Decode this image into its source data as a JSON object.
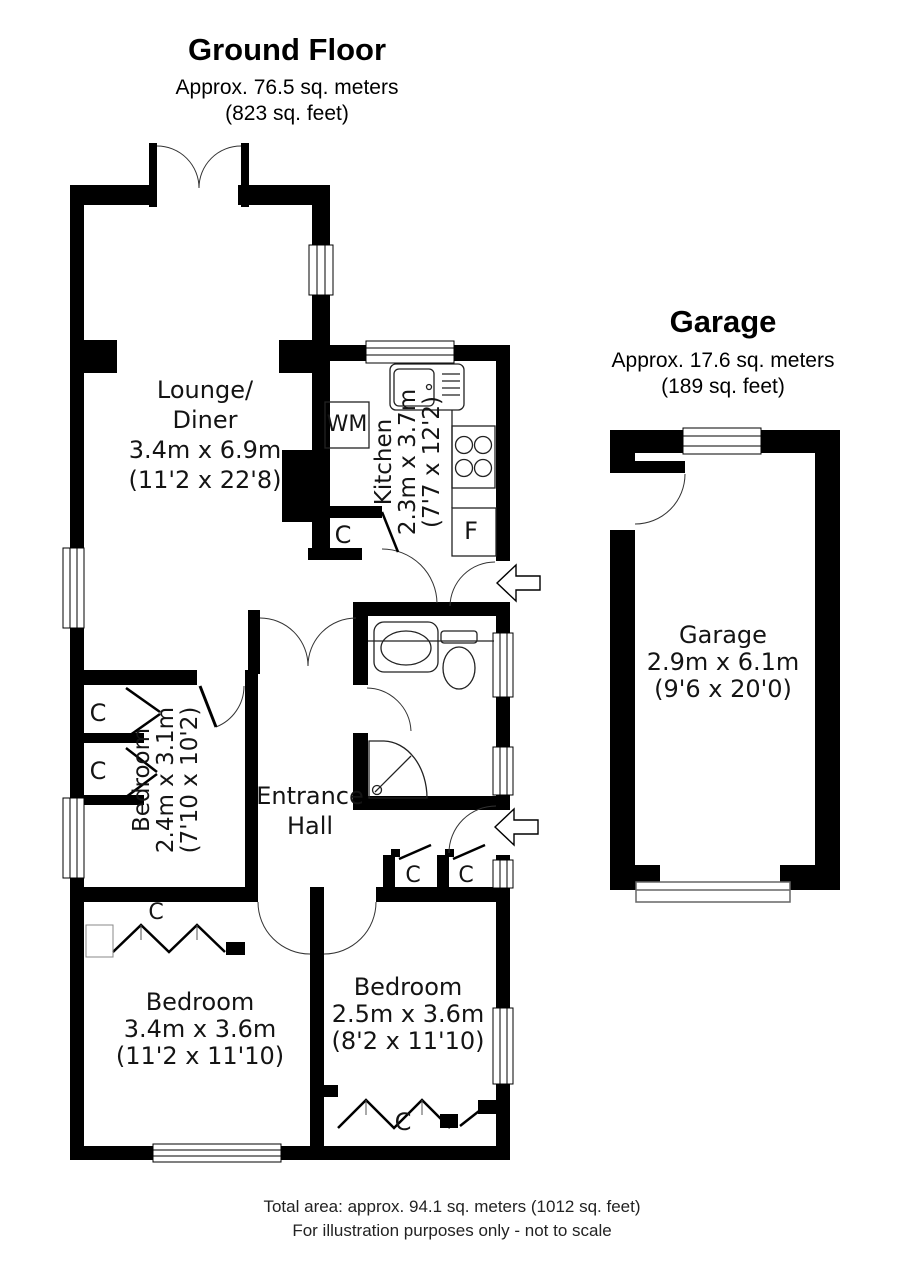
{
  "header": {
    "title": "Ground Floor",
    "area_metric": "Approx. 76.5 sq. meters",
    "area_imperial": "(823 sq. feet)"
  },
  "garage_header": {
    "title": "Garage",
    "area_metric": "Approx. 17.6 sq. meters",
    "area_imperial": "(189 sq. feet)"
  },
  "rooms": {
    "lounge": {
      "name_line1": "Lounge/",
      "name_line2": "Diner",
      "dims_metric": "3.4m x 6.9m",
      "dims_imperial": "(11'2 x 22'8)"
    },
    "kitchen": {
      "name": "Kitchen",
      "dims_metric": "2.3m x 3.7m",
      "dims_imperial": "(7'7 x 12'2)"
    },
    "bedroom_mid": {
      "name": "Bedroom",
      "dims_metric": "2.4m x 3.1m",
      "dims_imperial": "(7'10 x 10'2)"
    },
    "hall": {
      "name_line1": "Entrance",
      "name_line2": "Hall"
    },
    "bedroom_bottom_left": {
      "name": "Bedroom",
      "dims_metric": "3.4m x 3.6m",
      "dims_imperial": "(11'2 x 11'10)"
    },
    "bedroom_bottom_right": {
      "name": "Bedroom",
      "dims_metric": "2.5m x 3.6m",
      "dims_imperial": "(8'2 x 11'10)"
    },
    "garage": {
      "name": "Garage",
      "dims_metric": "2.9m x 6.1m",
      "dims_imperial": "(9'6 x 20'0)"
    }
  },
  "labels": {
    "washing_machine": "WM",
    "fridge": "F",
    "cupboard": "C"
  },
  "footer": {
    "line1": "Total area: approx. 94.1 sq. meters (1012 sq. feet)",
    "line2": "For illustration purposes only - not to scale"
  },
  "colors": {
    "wall": "#000000",
    "background": "#ffffff"
  }
}
